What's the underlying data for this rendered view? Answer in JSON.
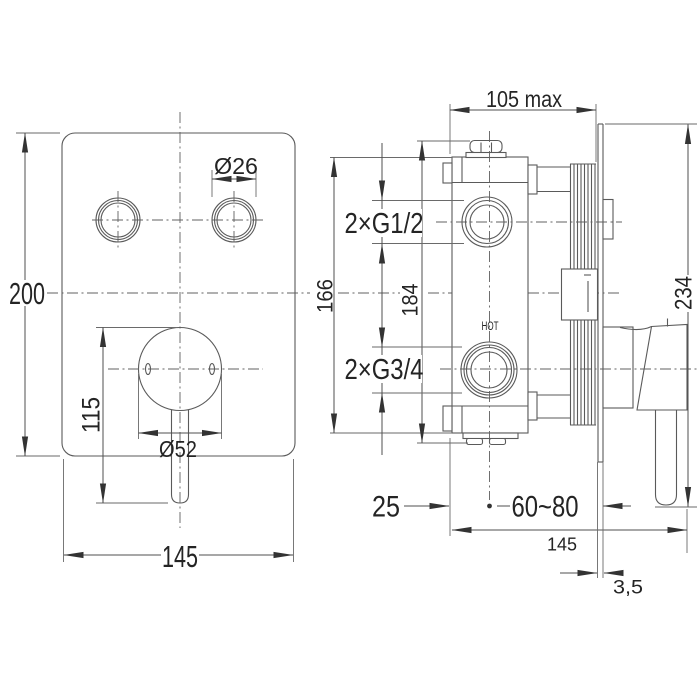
{
  "labels": {
    "front_view": {
      "height": "200",
      "width": "145",
      "knob_diameter": "Ø26",
      "handle_diameter": "Ø52",
      "handle_offset": "115"
    },
    "side_view": {
      "max_depth": "105 max",
      "body_height": "166",
      "mounting_height": "184",
      "overall_height": "234",
      "top_connections": "2×G1/2",
      "bottom_connections": "2×G3/4",
      "hot_marking": "HOT",
      "center_offset": "25",
      "installation_depth_range": "60~80",
      "overall_depth": "145",
      "plate_thickness": "3,5"
    }
  }
}
